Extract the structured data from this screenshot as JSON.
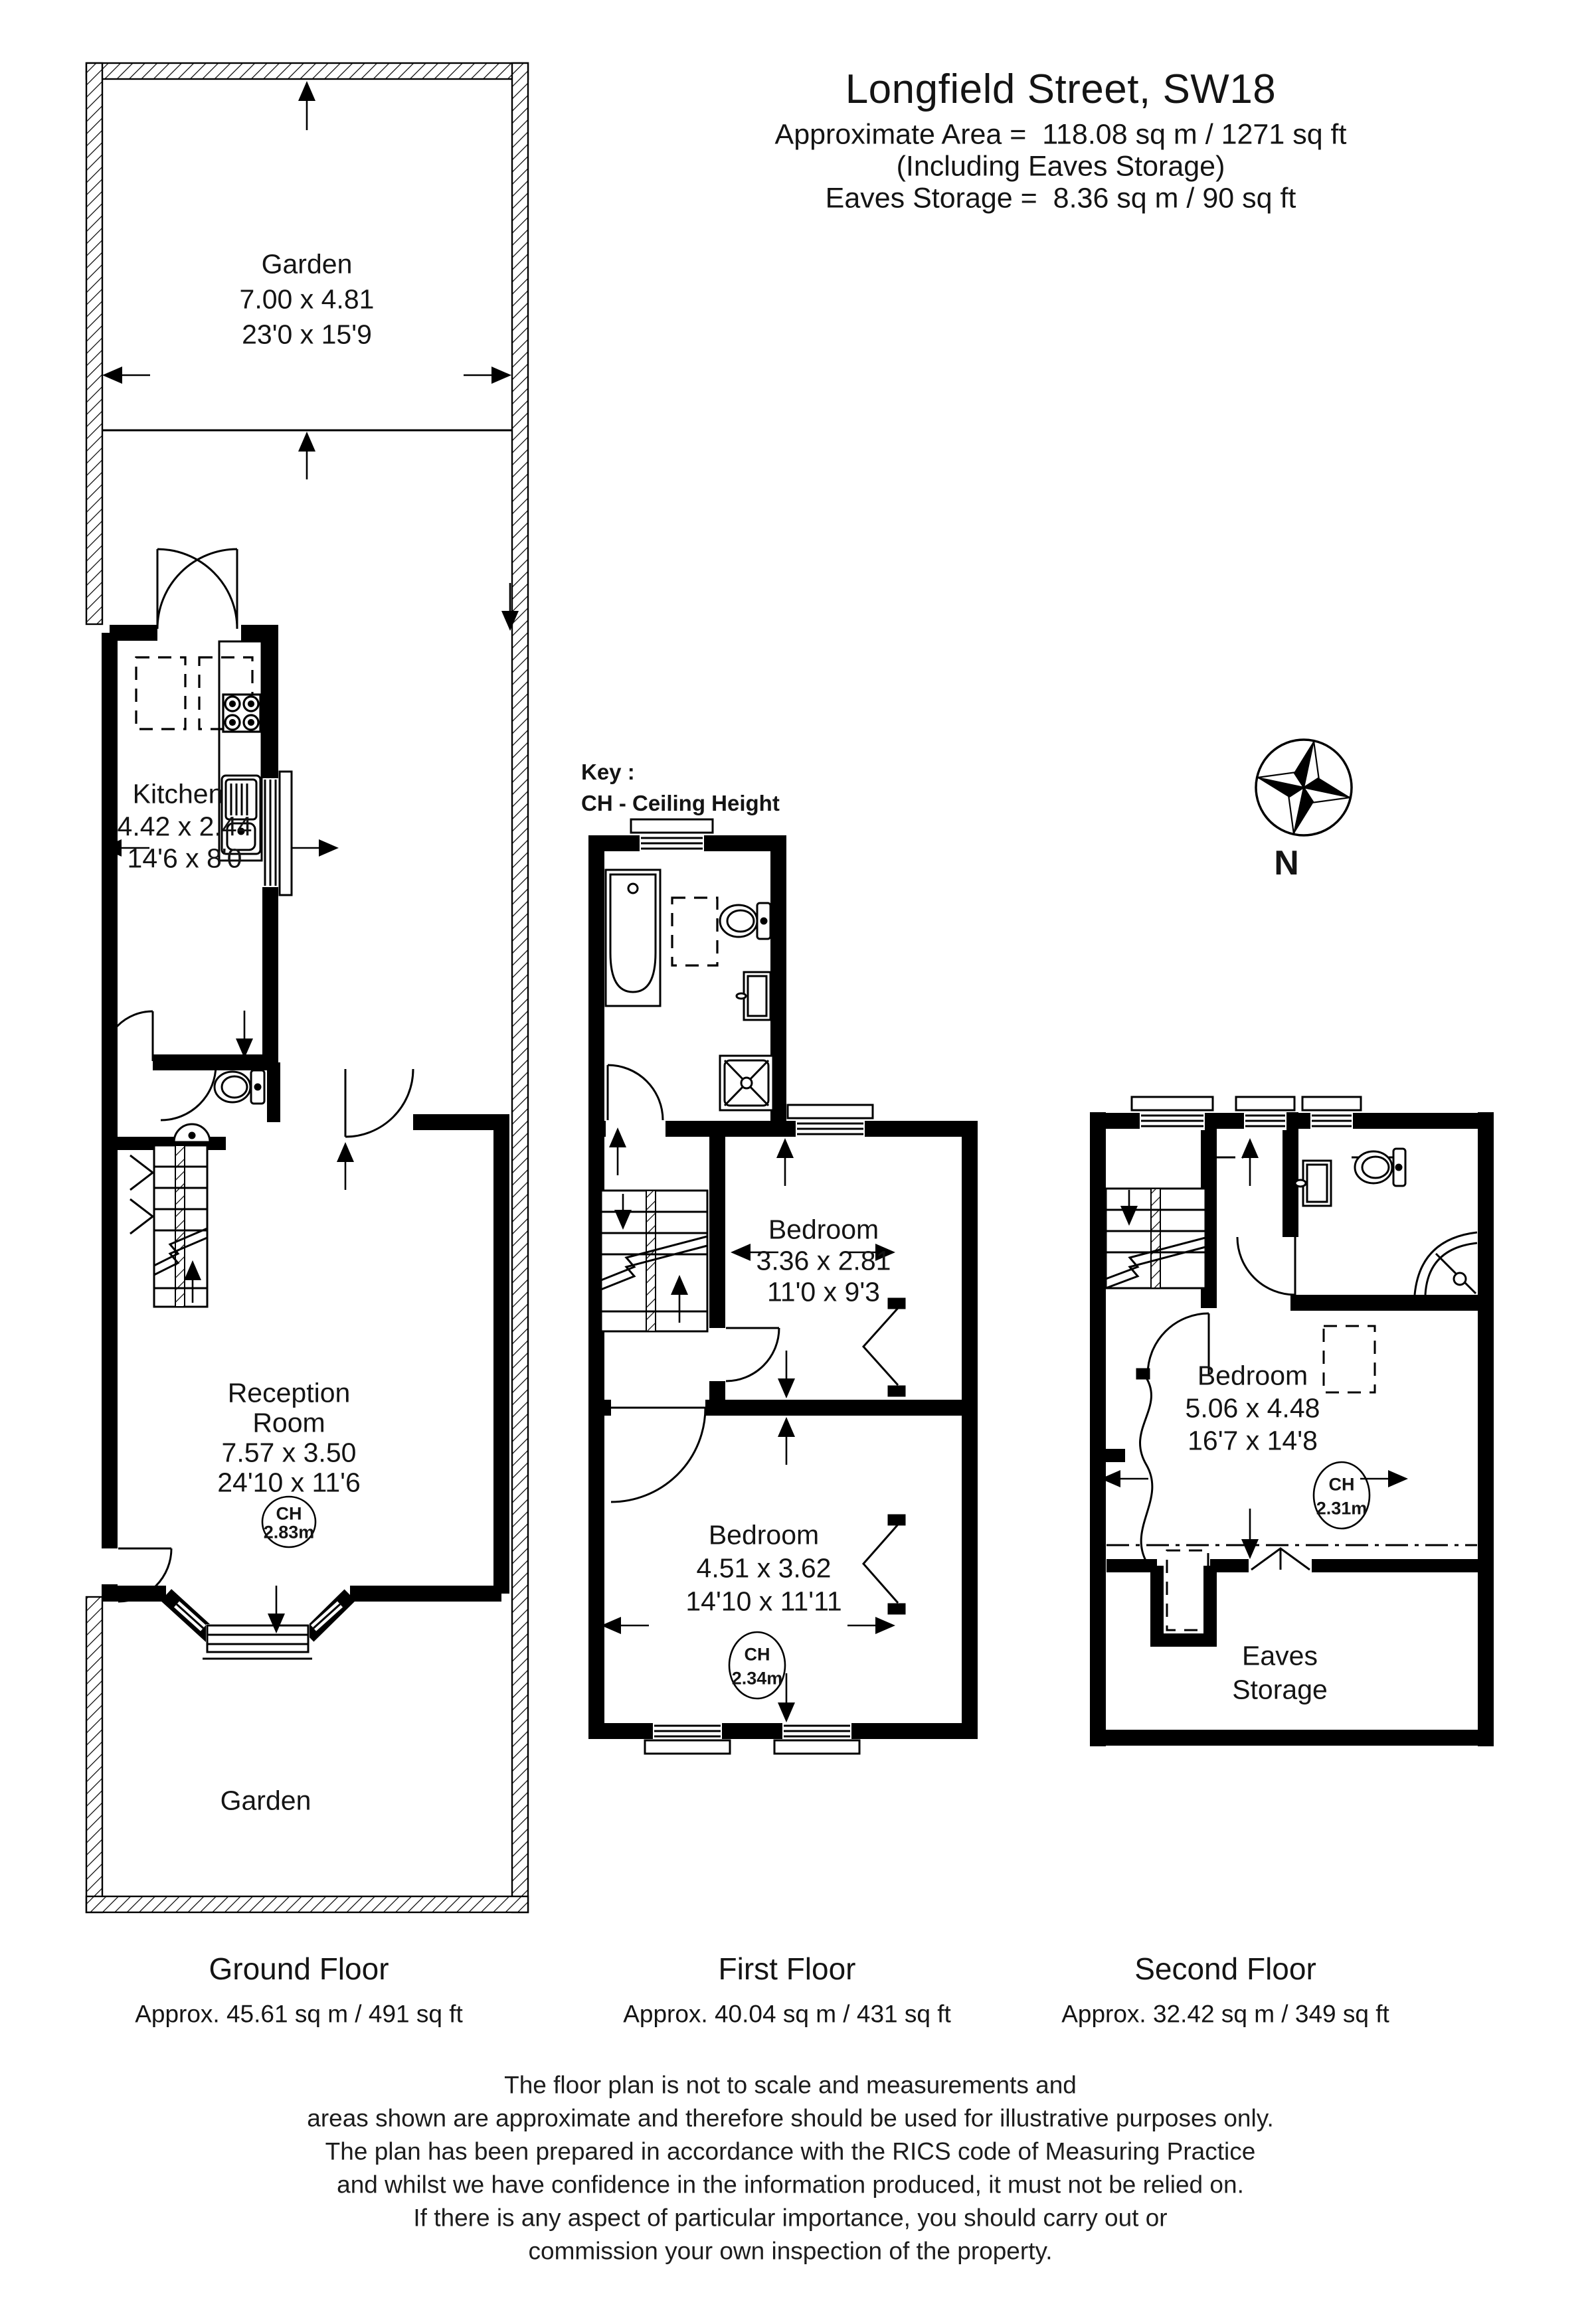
{
  "title": {
    "address": "Longfield Street, SW18",
    "area_line": "Approximate Area =  118.08 sq m / 1271 sq ft",
    "including_line": "(Including Eaves Storage)",
    "eaves_line": "Eaves Storage =  8.36 sq m / 90 sq ft"
  },
  "key": {
    "heading": "Key :",
    "ch_item": "CH - Ceiling Height"
  },
  "compass": {
    "north": "N"
  },
  "ground": {
    "rear_garden": {
      "name": "Garden",
      "metric": "7.00 x 4.81",
      "imperial": "23'0 x 15'9"
    },
    "kitchen": {
      "name": "Kitchen",
      "metric": "4.42 x 2.44",
      "imperial": "14'6 x 8'0"
    },
    "reception": {
      "name1": "Reception",
      "name2": "Room",
      "metric": "7.57 x 3.50",
      "imperial": "24'10 x 11'6",
      "ch_label": "CH",
      "ch_value": "2.83m"
    },
    "front_garden": {
      "name": "Garden"
    },
    "caption": {
      "title": "Ground Floor",
      "area": "Approx. 45.61 sq m / 491 sq ft"
    }
  },
  "first": {
    "bedroom_rear": {
      "name": "Bedroom",
      "metric": "3.36 x 2.81",
      "imperial": "11'0 x 9'3"
    },
    "bedroom_front": {
      "name": "Bedroom",
      "metric": "4.51 x 3.62",
      "imperial": "14'10 x 11'11",
      "ch_label": "CH",
      "ch_value": "2.34m"
    },
    "caption": {
      "title": "First Floor",
      "area": "Approx. 40.04 sq m / 431 sq ft"
    }
  },
  "second": {
    "bedroom": {
      "name": "Bedroom",
      "metric": "5.06 x 4.48",
      "imperial": "16'7 x 14'8",
      "ch_label": "CH",
      "ch_value": "2.31m"
    },
    "eaves": {
      "name1": "Eaves",
      "name2": "Storage"
    },
    "caption": {
      "title": "Second Floor",
      "area": "Approx. 32.42 sq m / 349 sq ft"
    }
  },
  "disclaimer": {
    "line1": "The floor plan is not to scale and measurements and",
    "line2": "areas shown are approximate and therefore should be used for illustrative purposes only.",
    "line3": "The plan has been prepared in accordance with the RICS code of Measuring Practice",
    "line4": "and whilst we have confidence in the information produced, it must not be relied on.",
    "line5": "If there is any aspect of particular importance, you should carry out or",
    "line6": "commission your own inspection of the property."
  }
}
